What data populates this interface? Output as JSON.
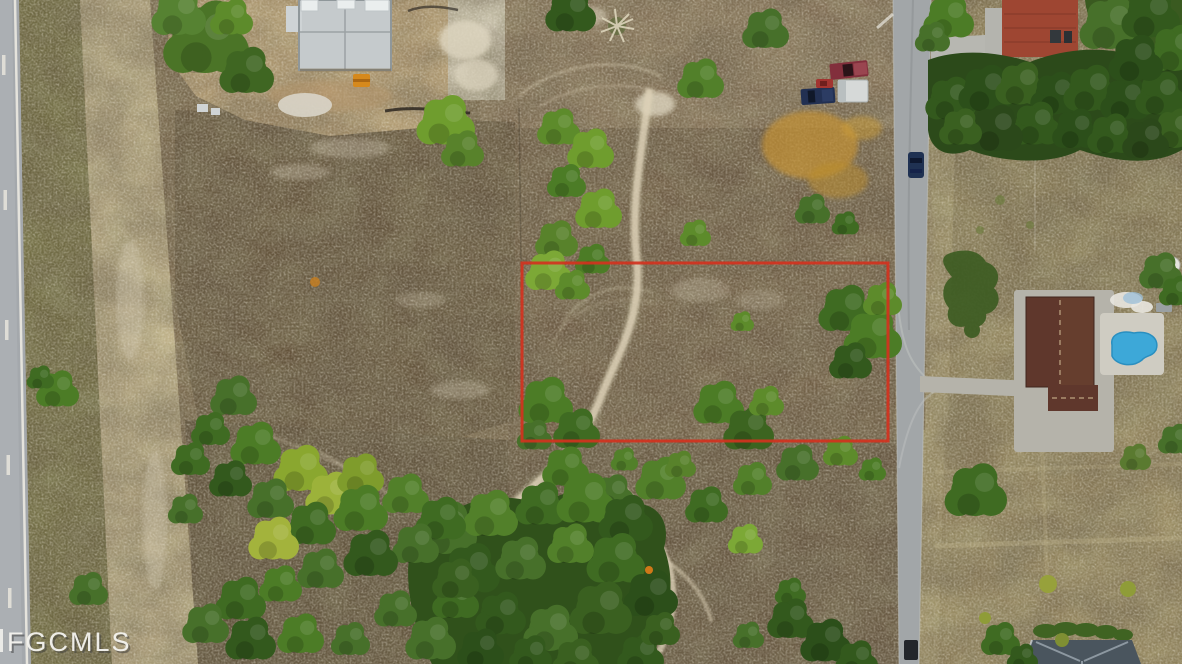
{
  "image": {
    "kind": "aerial-drone-photo",
    "subject": "Overhead aerial view of vacant residential land with a red lot-boundary outline, sandy trails, scattered trees, a paved road and neighboring houses (one under construction, one with a pool)",
    "watermark_text": "FGCMLS"
  },
  "watermark": {
    "text": "FGCMLS",
    "color": "#f5f4f0"
  },
  "boundary": {
    "label": "lot-boundary",
    "shape": "rectangle",
    "color": "#d2321e",
    "x": 522,
    "y": 263,
    "width": 366,
    "height": 178
  },
  "palette": {
    "ground": "#7d6a4e",
    "dark_scrub": "#63523a",
    "sand": "#c0b088",
    "trail": "#ddd2b8",
    "tree_green": "#4c7c26",
    "road_gray": "#a2a6a8",
    "pool_blue": "#3da8d8",
    "red_roof": "#9e4632",
    "brown_roof": "#5f372c",
    "slate_roof": "#4a555e",
    "dry_grass": "#c49232"
  }
}
